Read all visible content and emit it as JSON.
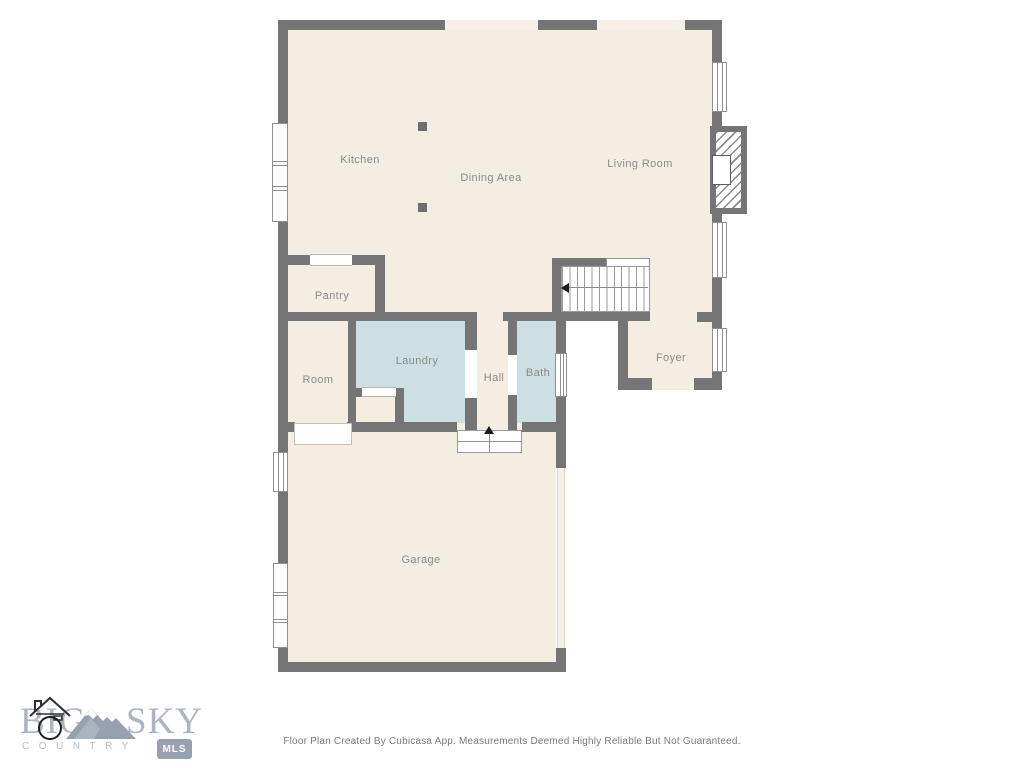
{
  "floorplan": {
    "rooms": [
      {
        "id": "kitchen",
        "label": "Kitchen"
      },
      {
        "id": "dining",
        "label": "Dining Area"
      },
      {
        "id": "living",
        "label": "Living Room"
      },
      {
        "id": "pantry",
        "label": "Pantry"
      },
      {
        "id": "room",
        "label": "Room"
      },
      {
        "id": "laundry",
        "label": "Laundry"
      },
      {
        "id": "hall",
        "label": "Hall"
      },
      {
        "id": "bath",
        "label": "Bath"
      },
      {
        "id": "foyer",
        "label": "Foyer"
      },
      {
        "id": "garage",
        "label": "Garage"
      }
    ],
    "colors": {
      "wall": "#757575",
      "floor": "#f4ede2",
      "wet_room_floor": "#cddfe2",
      "window": "#ffffff",
      "label_text": "#8a8a8a"
    },
    "stairs": {
      "direction_arrow": "left"
    },
    "entry_steps": {
      "direction_arrow": "up"
    }
  },
  "logo": {
    "word1": "BIG",
    "word2": "SKY",
    "tagline": "COUNTRY",
    "badge": "MLS",
    "brand_color": "#adb4c2"
  },
  "footer": {
    "text": "Floor Plan Created By Cubicasa App. Measurements Deemed Highly Reliable But Not Guaranteed."
  }
}
